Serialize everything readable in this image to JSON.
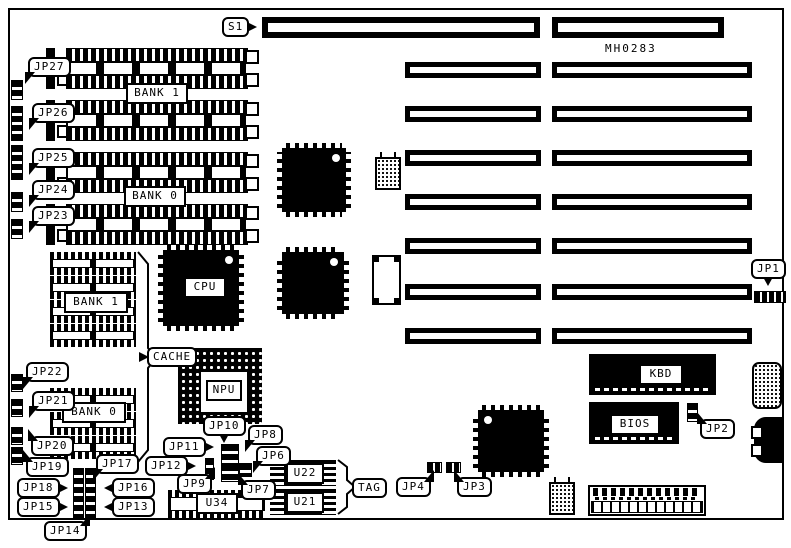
{
  "board": {
    "part_number": "MH0283"
  },
  "labels": {
    "s1": "S1",
    "jp1": "JP1",
    "jp2": "JP2",
    "jp3": "JP3",
    "jp4": "JP4",
    "jp6": "JP6",
    "jp7": "JP7",
    "jp8": "JP8",
    "jp9": "JP9",
    "jp10": "JP10",
    "jp11": "JP11",
    "jp12": "JP12",
    "jp13": "JP13",
    "jp14": "JP14",
    "jp15": "JP15",
    "jp16": "JP16",
    "jp17": "JP17",
    "jp18": "JP18",
    "jp19": "JP19",
    "jp20": "JP20",
    "jp21": "JP21",
    "jp22": "JP22",
    "jp23": "JP23",
    "jp24": "JP24",
    "jp25": "JP25",
    "jp26": "JP26",
    "jp27": "JP27",
    "bank1_simm": "BANK 1",
    "bank0_simm": "BANK 0",
    "bank1_dip": "BANK 1",
    "bank0_dip": "BANK 0",
    "cpu": "CPU",
    "cache": "CACHE",
    "npu": "NPU",
    "kbd": "KBD",
    "bios": "BIOS",
    "u22": "U22",
    "u21": "U21",
    "u34": "U34",
    "tag": "TAG"
  },
  "colors": {
    "ink": "#000000",
    "paper": "#ffffff"
  }
}
